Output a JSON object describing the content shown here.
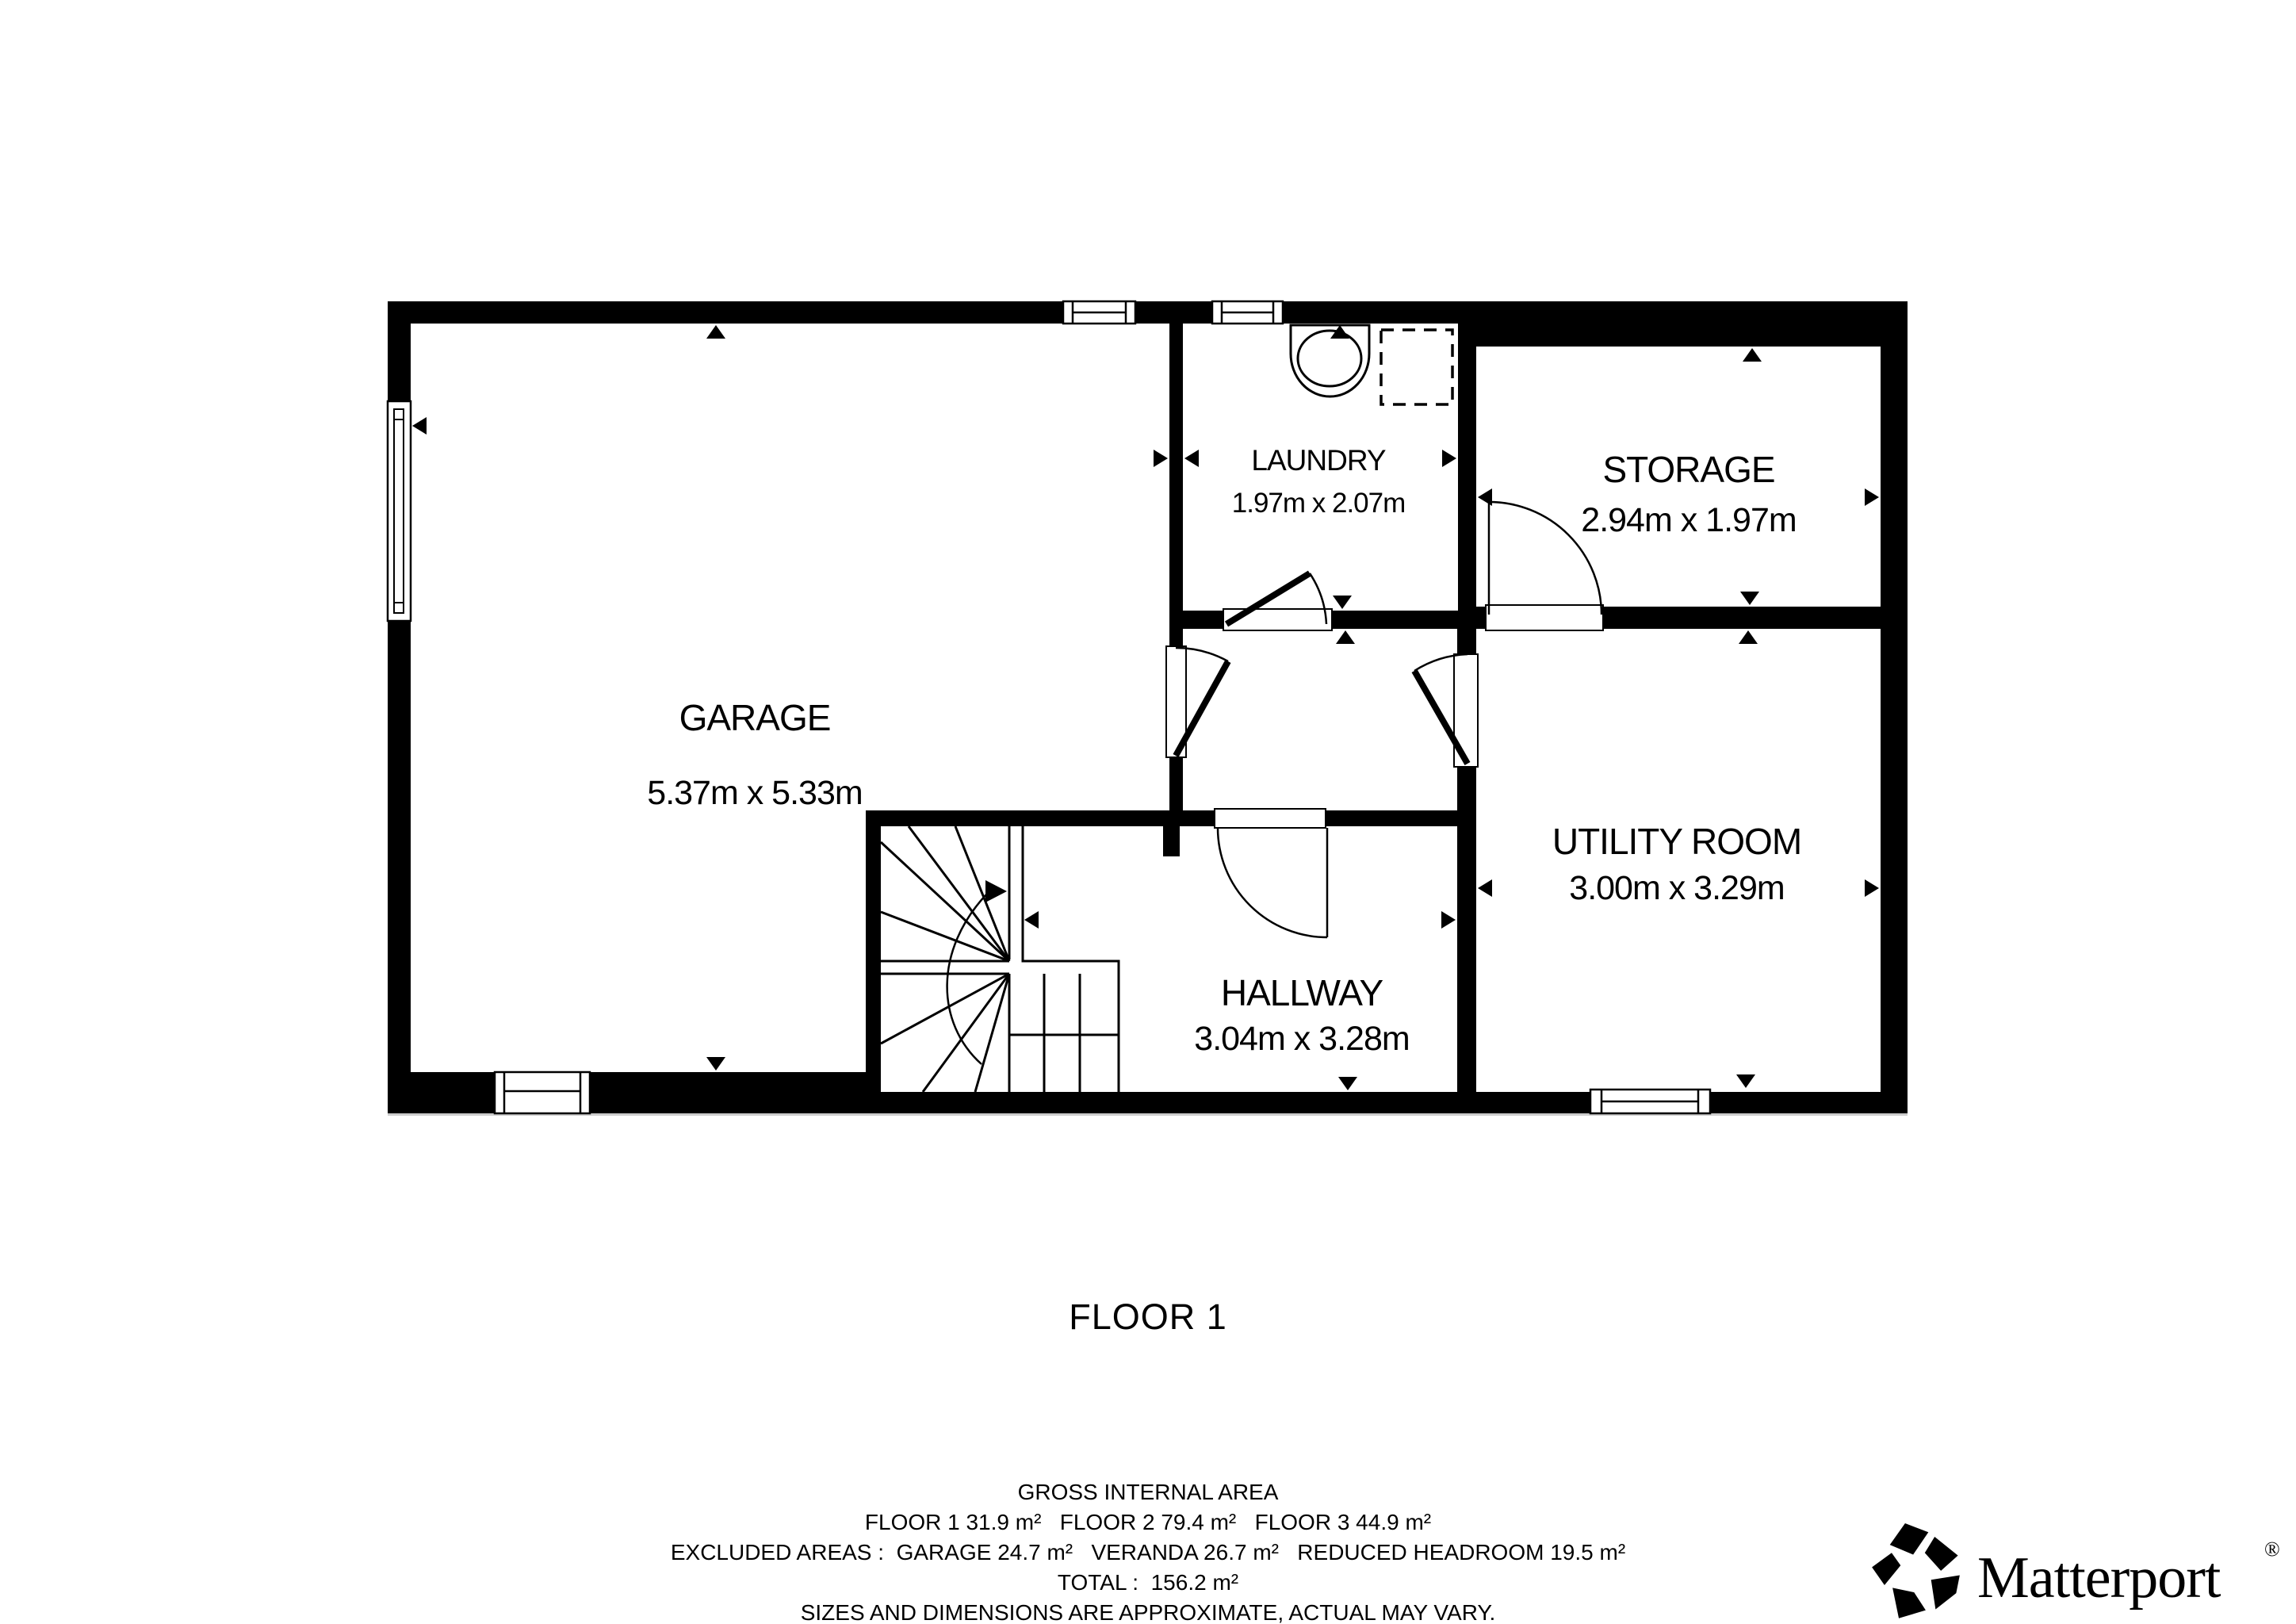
{
  "floor_label": "FLOOR 1",
  "rooms": {
    "garage": {
      "name": "GARAGE",
      "dims": "5.37m x 5.33m"
    },
    "laundry": {
      "name": "LAUNDRY",
      "dims": "1.97m x 2.07m"
    },
    "storage": {
      "name": "STORAGE",
      "dims": "2.94m x 1.97m"
    },
    "utility": {
      "name": "UTILITY ROOM",
      "dims": "3.00m x 3.29m"
    },
    "hallway": {
      "name": "HALLWAY",
      "dims": "3.04m x 3.28m"
    }
  },
  "footer": {
    "line1": "GROSS INTERNAL AREA",
    "line2": "FLOOR 1 31.9 m²   FLOOR 2 79.4 m²   FLOOR 3 44.9 m²",
    "line3": "EXCLUDED AREAS :  GARAGE 24.7 m²   VERANDA 26.7 m²   REDUCED HEADROOM 19.5 m²",
    "line4": "TOTAL :  156.2 m²",
    "line5": "SIZES AND DIMENSIONS ARE APPROXIMATE, ACTUAL MAY VARY."
  },
  "branding": {
    "wordmark": "Matterport",
    "registered": "®"
  },
  "colors": {
    "ink": "#000000",
    "muted": "#7d7d7d",
    "background": "#ffffff"
  }
}
